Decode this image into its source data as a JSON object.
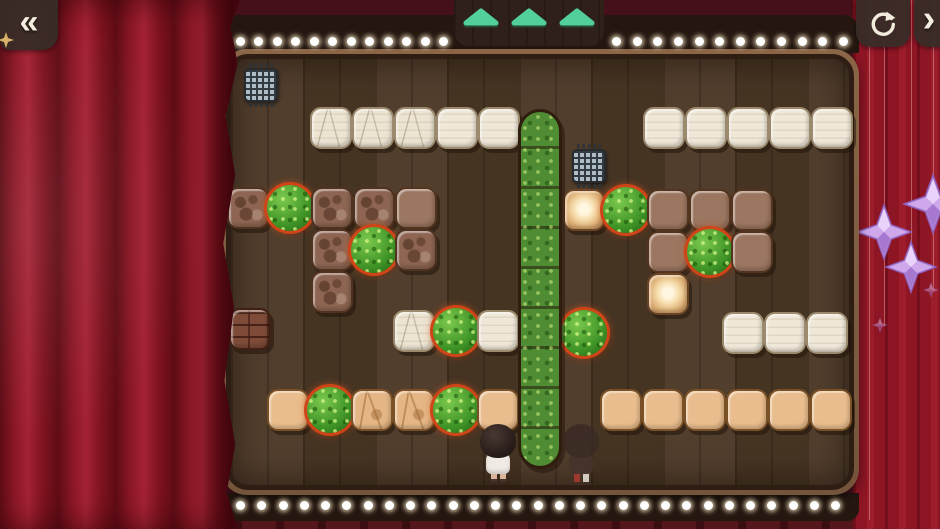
{
  "window": {
    "width": 940,
    "height": 529
  },
  "hud": {
    "undo_button": {
      "icon": "undo-double-chevron",
      "glyph": "«",
      "ornament_icon": "gold-sparkle"
    },
    "restart_button": {
      "icon": "restart-circular-arrow"
    },
    "next_button": {
      "icon": "chevron-right",
      "glyph": "›"
    },
    "progress_arrows": {
      "count": 3,
      "color": "#52cf9b"
    }
  },
  "theater": {
    "curtain_color": "#8b1723",
    "backdrop_color": "#45101a",
    "marquee_color": "#251710",
    "bulb_color": "#ffffff",
    "bulb_counts": {
      "top_left": 12,
      "top_right": 12,
      "bottom": 29
    },
    "sparkle_color": "#c9a2e8",
    "sparkles": [
      {
        "x": 933,
        "y": 204,
        "size": 62,
        "dim": false
      },
      {
        "x": 884,
        "y": 232,
        "size": 58,
        "dim": false
      },
      {
        "x": 911,
        "y": 267,
        "size": 54,
        "dim": false
      },
      {
        "x": 931,
        "y": 290,
        "size": 16,
        "dim": true
      },
      {
        "x": 880,
        "y": 325,
        "size": 16,
        "dim": true
      }
    ],
    "strings": [
      {
        "x": 869,
        "h": 520
      },
      {
        "x": 884,
        "h": 325
      },
      {
        "x": 911,
        "h": 267
      },
      {
        "x": 933,
        "h": 290
      }
    ]
  },
  "board": {
    "tile_size": 42,
    "floor_color": "#4c3826",
    "bush_outline_color": "#d04418",
    "tiles": [
      {
        "t": "white_marked",
        "x": 310,
        "y": 107
      },
      {
        "t": "white_marked",
        "x": 352,
        "y": 107
      },
      {
        "t": "white_marked",
        "x": 394,
        "y": 107
      },
      {
        "t": "white",
        "x": 436,
        "y": 107
      },
      {
        "t": "white",
        "x": 478,
        "y": 107
      },
      {
        "t": "white",
        "x": 643,
        "y": 107
      },
      {
        "t": "white",
        "x": 685,
        "y": 107
      },
      {
        "t": "white",
        "x": 727,
        "y": 107
      },
      {
        "t": "white",
        "x": 769,
        "y": 107
      },
      {
        "t": "white",
        "x": 811,
        "y": 107
      },
      {
        "t": "brown_marked",
        "x": 227,
        "y": 187
      },
      {
        "t": "bush",
        "x": 269,
        "y": 187
      },
      {
        "t": "brown_marked",
        "x": 311,
        "y": 187
      },
      {
        "t": "brown_marked",
        "x": 353,
        "y": 187
      },
      {
        "t": "brown_smooth",
        "x": 395,
        "y": 187
      },
      {
        "t": "brown_marked",
        "x": 311,
        "y": 229
      },
      {
        "t": "bush",
        "x": 353,
        "y": 229
      },
      {
        "t": "brown_marked",
        "x": 395,
        "y": 229
      },
      {
        "t": "brown_marked",
        "x": 311,
        "y": 271
      },
      {
        "t": "brick",
        "x": 229,
        "y": 308
      },
      {
        "t": "white_marked",
        "x": 393,
        "y": 310
      },
      {
        "t": "bush",
        "x": 435,
        "y": 310
      },
      {
        "t": "white",
        "x": 477,
        "y": 310
      },
      {
        "t": "glow",
        "x": 563,
        "y": 189
      },
      {
        "t": "bush",
        "x": 605,
        "y": 189
      },
      {
        "t": "brown_smooth",
        "x": 647,
        "y": 189
      },
      {
        "t": "brown_smooth",
        "x": 689,
        "y": 189
      },
      {
        "t": "brown_smooth",
        "x": 731,
        "y": 189
      },
      {
        "t": "brown_smooth",
        "x": 647,
        "y": 231
      },
      {
        "t": "bush",
        "x": 689,
        "y": 231
      },
      {
        "t": "brown_smooth",
        "x": 731,
        "y": 231
      },
      {
        "t": "glow",
        "x": 647,
        "y": 273
      },
      {
        "t": "bush",
        "x": 563,
        "y": 312
      },
      {
        "t": "white",
        "x": 722,
        "y": 312
      },
      {
        "t": "white",
        "x": 764,
        "y": 312
      },
      {
        "t": "white",
        "x": 806,
        "y": 312
      },
      {
        "t": "tan",
        "x": 267,
        "y": 389
      },
      {
        "t": "bush",
        "x": 309,
        "y": 389
      },
      {
        "t": "tan_marked",
        "x": 351,
        "y": 389
      },
      {
        "t": "tan_marked",
        "x": 393,
        "y": 389
      },
      {
        "t": "bush",
        "x": 435,
        "y": 389
      },
      {
        "t": "tan",
        "x": 477,
        "y": 389
      },
      {
        "t": "tan",
        "x": 600,
        "y": 389
      },
      {
        "t": "tan",
        "x": 642,
        "y": 389
      },
      {
        "t": "tan",
        "x": 684,
        "y": 389
      },
      {
        "t": "tan",
        "x": 726,
        "y": 389
      },
      {
        "t": "tan",
        "x": 768,
        "y": 389
      },
      {
        "t": "tan",
        "x": 810,
        "y": 389
      }
    ],
    "hedge": {
      "x": 518,
      "y": 109,
      "width": 44,
      "cell": 40,
      "cells": 9
    },
    "grates": [
      {
        "x": 242,
        "y": 62
      },
      {
        "x": 570,
        "y": 143
      }
    ],
    "players": [
      {
        "x": 478,
        "y": 424,
        "variant": "active"
      },
      {
        "x": 561,
        "y": 424,
        "variant": "shadow"
      }
    ]
  }
}
